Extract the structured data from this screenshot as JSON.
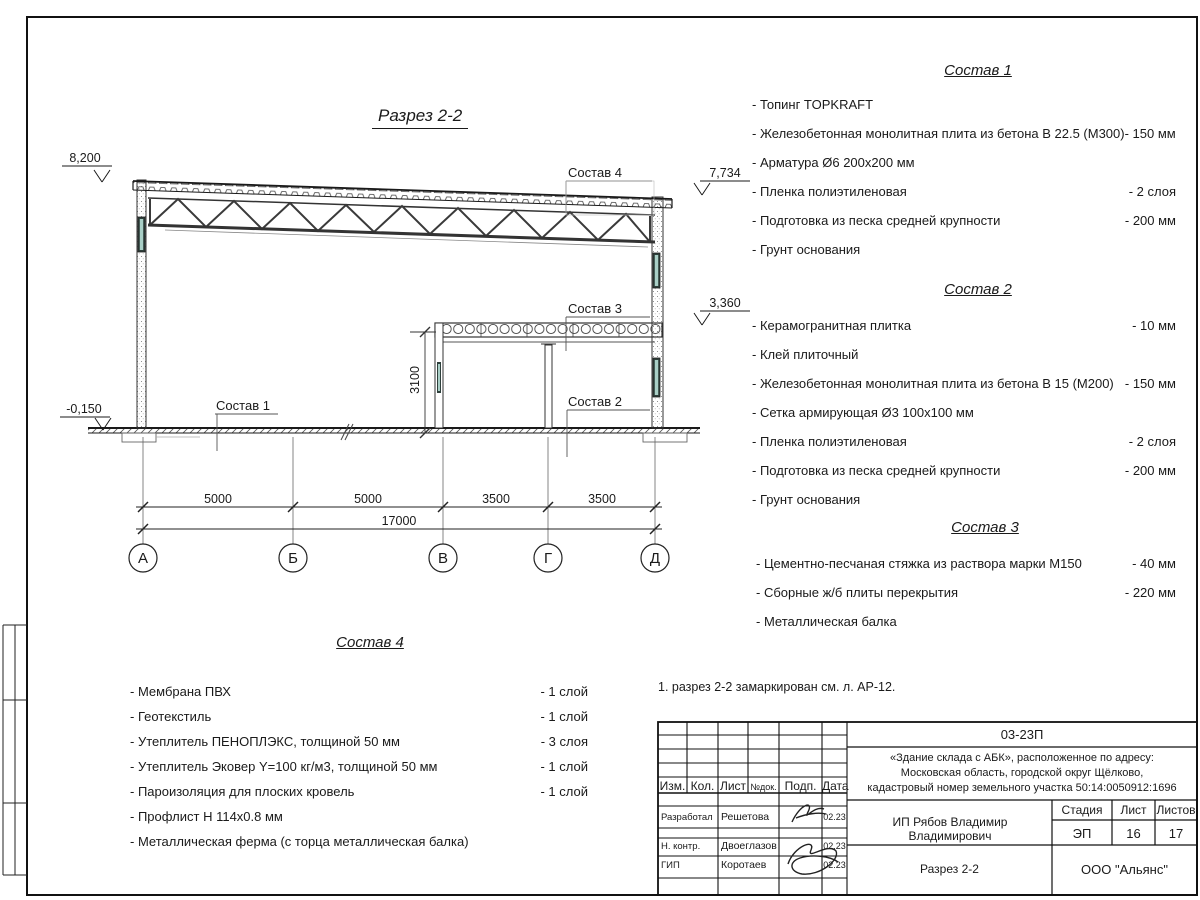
{
  "accent_colors": {
    "line": "#1a1a1a",
    "glass": "#a9cfc6",
    "frame_dark": "#2e3f3b"
  },
  "view": {
    "title": "Разрез 2-2"
  },
  "note": "1. разрез 2-2 замаркирован см. л. АР-12.",
  "drawing": {
    "elevations": {
      "roof_left": "8,200",
      "roof_right": "7,734",
      "annex_roof": "3,360",
      "floor": "-0,150"
    },
    "dims": {
      "span1": "5000",
      "span2": "5000",
      "span3": "3500",
      "span4": "3500",
      "total": "17000",
      "annex_height": "3100"
    },
    "axes": [
      "А",
      "Б",
      "В",
      "Г",
      "Д"
    ],
    "callouts": {
      "c1": "Состав 1",
      "c2": "Состав 2",
      "c3": "Состав 3",
      "c4": "Состав 4"
    }
  },
  "comp1": {
    "title": "Состав 1",
    "items": [
      {
        "name": "- Топинг TOPKRAFT",
        "value": ""
      },
      {
        "name": "- Железобетонная  монолитная плита из бетона  В 22.5 (М300)- 150 мм",
        "value": ""
      },
      {
        "name": "- Арматура Ø6 200х200 мм",
        "value": ""
      },
      {
        "name": "- Пленка полиэтиленовая",
        "value": "-  2 слоя"
      },
      {
        "name": "- Подготовка из песка средней  крупности",
        "value": "- 200 мм"
      },
      {
        "name": "- Грунт основания",
        "value": ""
      }
    ]
  },
  "comp2": {
    "title": "Состав 2",
    "items": [
      {
        "name": "- Керамогранитная плитка",
        "value": "- 10 мм"
      },
      {
        "name": "- Клей плиточный",
        "value": ""
      },
      {
        "name": "- Железобетонная  монолитная плита из бетона В 15 (М200)",
        "value": "- 150 мм"
      },
      {
        "name": "- Сетка армирующая Ø3 100х100 мм",
        "value": ""
      },
      {
        "name": "- Пленка полиэтиленовая",
        "value": "-  2 слоя"
      },
      {
        "name": "- Подготовка из песка средней  крупности",
        "value": "- 200 мм"
      },
      {
        "name": "- Грунт основания",
        "value": ""
      }
    ]
  },
  "comp3": {
    "title": "Состав 3",
    "items": [
      {
        "name": "- Цементно-песчаная стяжка  из раствора марки М150",
        "value": "- 40 мм"
      },
      {
        "name": "- Сборные ж/б плиты перекрытия",
        "value": "- 220 мм"
      },
      {
        "name": "- Металлическая  балка",
        "value": ""
      }
    ]
  },
  "comp4": {
    "title": "Состав 4",
    "items": [
      {
        "name": "- Мембрана ПВХ",
        "value": "- 1 слой"
      },
      {
        "name": "- Геотекстиль",
        "value": "- 1 слой"
      },
      {
        "name": "- Утеплитель ПЕНОПЛЭКС, толщиной 50 мм",
        "value": "- 3 слоя"
      },
      {
        "name": "- Утеплитель Эковер Y=100 кг/м3, толщиной 50 мм",
        "value": "- 1 слой"
      },
      {
        "name": "- Пароизоляция для плоских кровель",
        "value": "- 1 слой"
      },
      {
        "name": "- Профлист Н 114х0.8 мм",
        "value": ""
      },
      {
        "name": "- Металлическая ферма (с торца металлическая балка)",
        "value": ""
      }
    ]
  },
  "titleblock": {
    "code": "03-23П",
    "project": "«Здание склада с АБК», расположенное по адресу:\nМосковская область, городской округ Щёлково,\nкадастровый номер земельного участка 50:14:0050912:1696",
    "client": "ИП Рябов Владимир Владимирович",
    "view": "Разрез 2-2",
    "company": "ООО \"Альянс\"",
    "cols": {
      "izm": "Изм.",
      "kol": "Кол.",
      "list": "Лист",
      "ndoc": "№док.",
      "podp": "Подп.",
      "data": "Дата"
    },
    "rows": [
      {
        "role": "Разработал",
        "name": "Решетова",
        "date": "02.23"
      },
      {
        "role": "Н. контр.",
        "name": "Двоеглазов",
        "date": "02.23"
      },
      {
        "role": "ГИП",
        "name": "Коротаев",
        "date": "02.23"
      }
    ],
    "stage_label": "Стадия",
    "sheet_label": "Лист",
    "sheets_label": "Листов",
    "stage": "ЭП",
    "sheet": "16",
    "sheets": "17"
  }
}
